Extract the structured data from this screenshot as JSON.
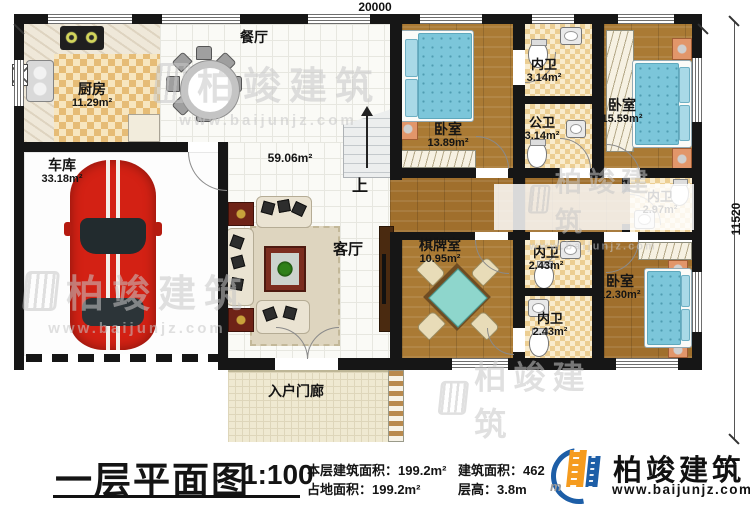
{
  "plan": {
    "dim_top": "20000",
    "dim_right": "11520",
    "stairs_up_label": "上",
    "rooms": {
      "kitchen": {
        "name": "厨房",
        "area": "11.29m²"
      },
      "dining": {
        "name": "餐厅",
        "area": ""
      },
      "garage": {
        "name": "车库",
        "area": "33.18m²"
      },
      "living": {
        "name": "客厅",
        "area": "59.06m²"
      },
      "bedroom1": {
        "name": "卧室",
        "area": "13.89m²"
      },
      "bath_inner_top": {
        "name": "内卫",
        "area": "3.14m²"
      },
      "bath_public": {
        "name": "公卫",
        "area": "3.14m²"
      },
      "bedroom2": {
        "name": "卧室",
        "area": "15.59m²"
      },
      "bath_inner_right": {
        "name": "内卫",
        "area": "2.97m²"
      },
      "chess": {
        "name": "棋牌室",
        "area": "10.95m²"
      },
      "bath_inner_mid": {
        "name": "内卫",
        "area": "2.43m²"
      },
      "bath_inner_low": {
        "name": "内卫",
        "area": "2.43m²"
      },
      "bedroom3": {
        "name": "卧室",
        "area": "12.30m²"
      },
      "porch": {
        "name": "入户门廊",
        "area": ""
      }
    }
  },
  "titleblock": {
    "title": "一层平面图",
    "scale": "1:100",
    "stats": [
      {
        "label": "本层建筑面积：",
        "value": "199.2m²"
      },
      {
        "label": "占地面积：",
        "value": "199.2m²"
      },
      {
        "label": "建筑面积：",
        "value": "462"
      },
      {
        "label": "层高：",
        "value": "3.8m"
      }
    ]
  },
  "brand": {
    "name": "柏竣建筑",
    "url": "www.baijunjz.com"
  },
  "watermark": {
    "name": "柏竣建筑",
    "url": "www.baijunjz.com"
  },
  "colors": {
    "wall": "#161616",
    "wood_floor": "#aa7a34",
    "bed_blue": "#7cc6da",
    "brand_blue": "#1d5ea7",
    "brand_orange": "#f59b1e",
    "watermark_gray": "#c7c7c7"
  }
}
